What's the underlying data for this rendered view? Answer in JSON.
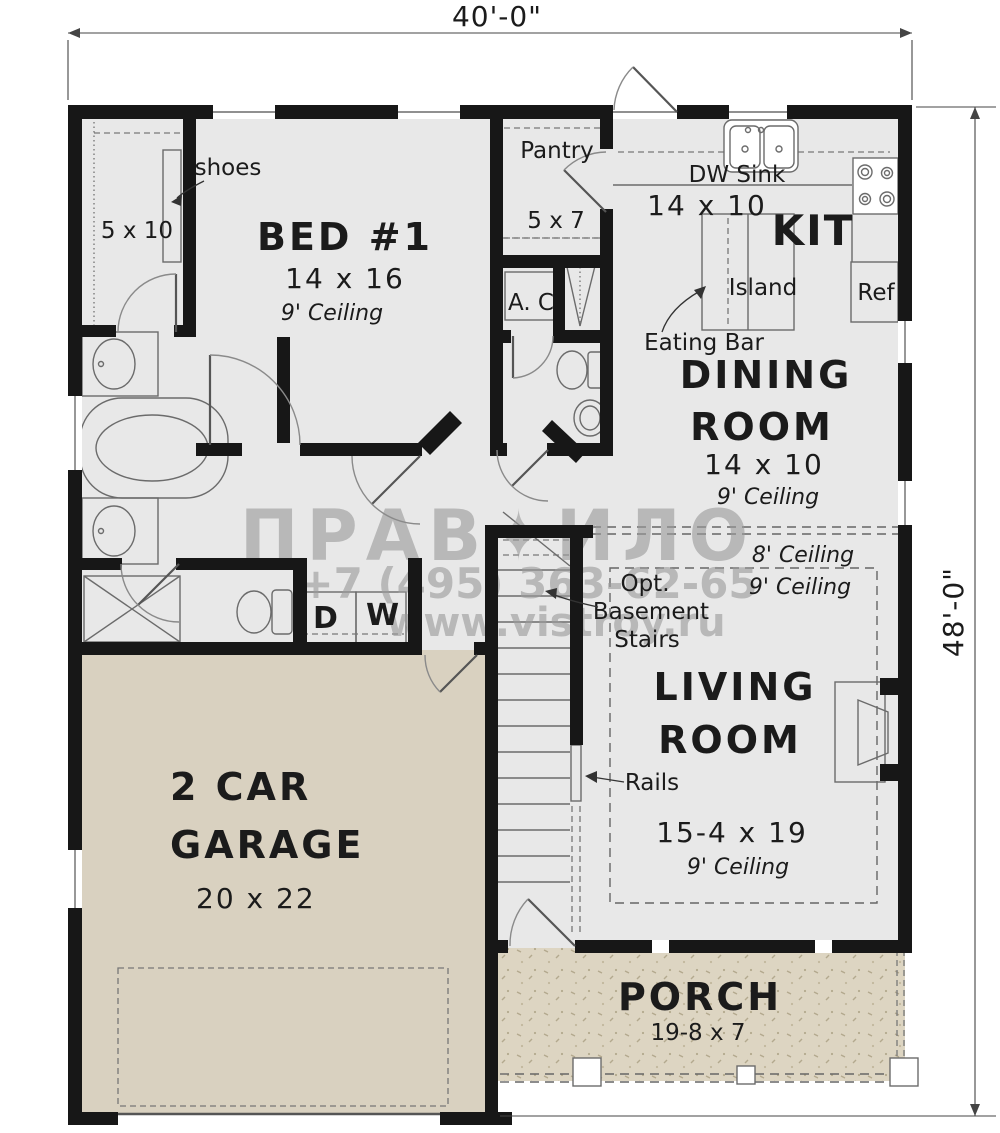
{
  "dimensions": {
    "width": "40'-0\"",
    "height": "48'-0\""
  },
  "watermark": {
    "brand": "ПРАВ✦ИЛО",
    "phone": "+7 (495) 363-62-65",
    "site": "www.vistroy.ru"
  },
  "rooms": {
    "bed1": {
      "name": "BED #1",
      "size": "14 x 16",
      "ceiling": "9' Ceiling"
    },
    "closet": {
      "size": "5 x 10",
      "shoes_label": "shoes"
    },
    "pantry": {
      "name": "Pantry",
      "size": "5 x 7"
    },
    "ac": {
      "name": "A. C"
    },
    "kitchen": {
      "name": "KIT",
      "size": "14 x 10",
      "dw_sink": "DW Sink",
      "island": "Island",
      "eating_bar": "Eating Bar",
      "ref": "Ref"
    },
    "dining": {
      "name_line1": "DINING",
      "name_line2": "ROOM",
      "size": "14 x 10",
      "ceiling": "9' Ceiling"
    },
    "living": {
      "name_line1": "LIVING",
      "name_line2": "ROOM",
      "size": "15-4 x 19",
      "ceiling": "9' Ceiling",
      "ceiling_8": "8' Ceiling",
      "ceiling_9": "9' Ceiling",
      "rails": "Rails"
    },
    "stairs": {
      "line1": "Opt.",
      "line2": "Basement",
      "line3": "Stairs"
    },
    "laundry": {
      "dryer": "D",
      "washer": "W"
    },
    "garage": {
      "name_line1": "2 CAR",
      "name_line2": "GARAGE",
      "size": "20 x 22"
    },
    "porch": {
      "name": "PORCH",
      "size": "19-8 x 7"
    }
  }
}
